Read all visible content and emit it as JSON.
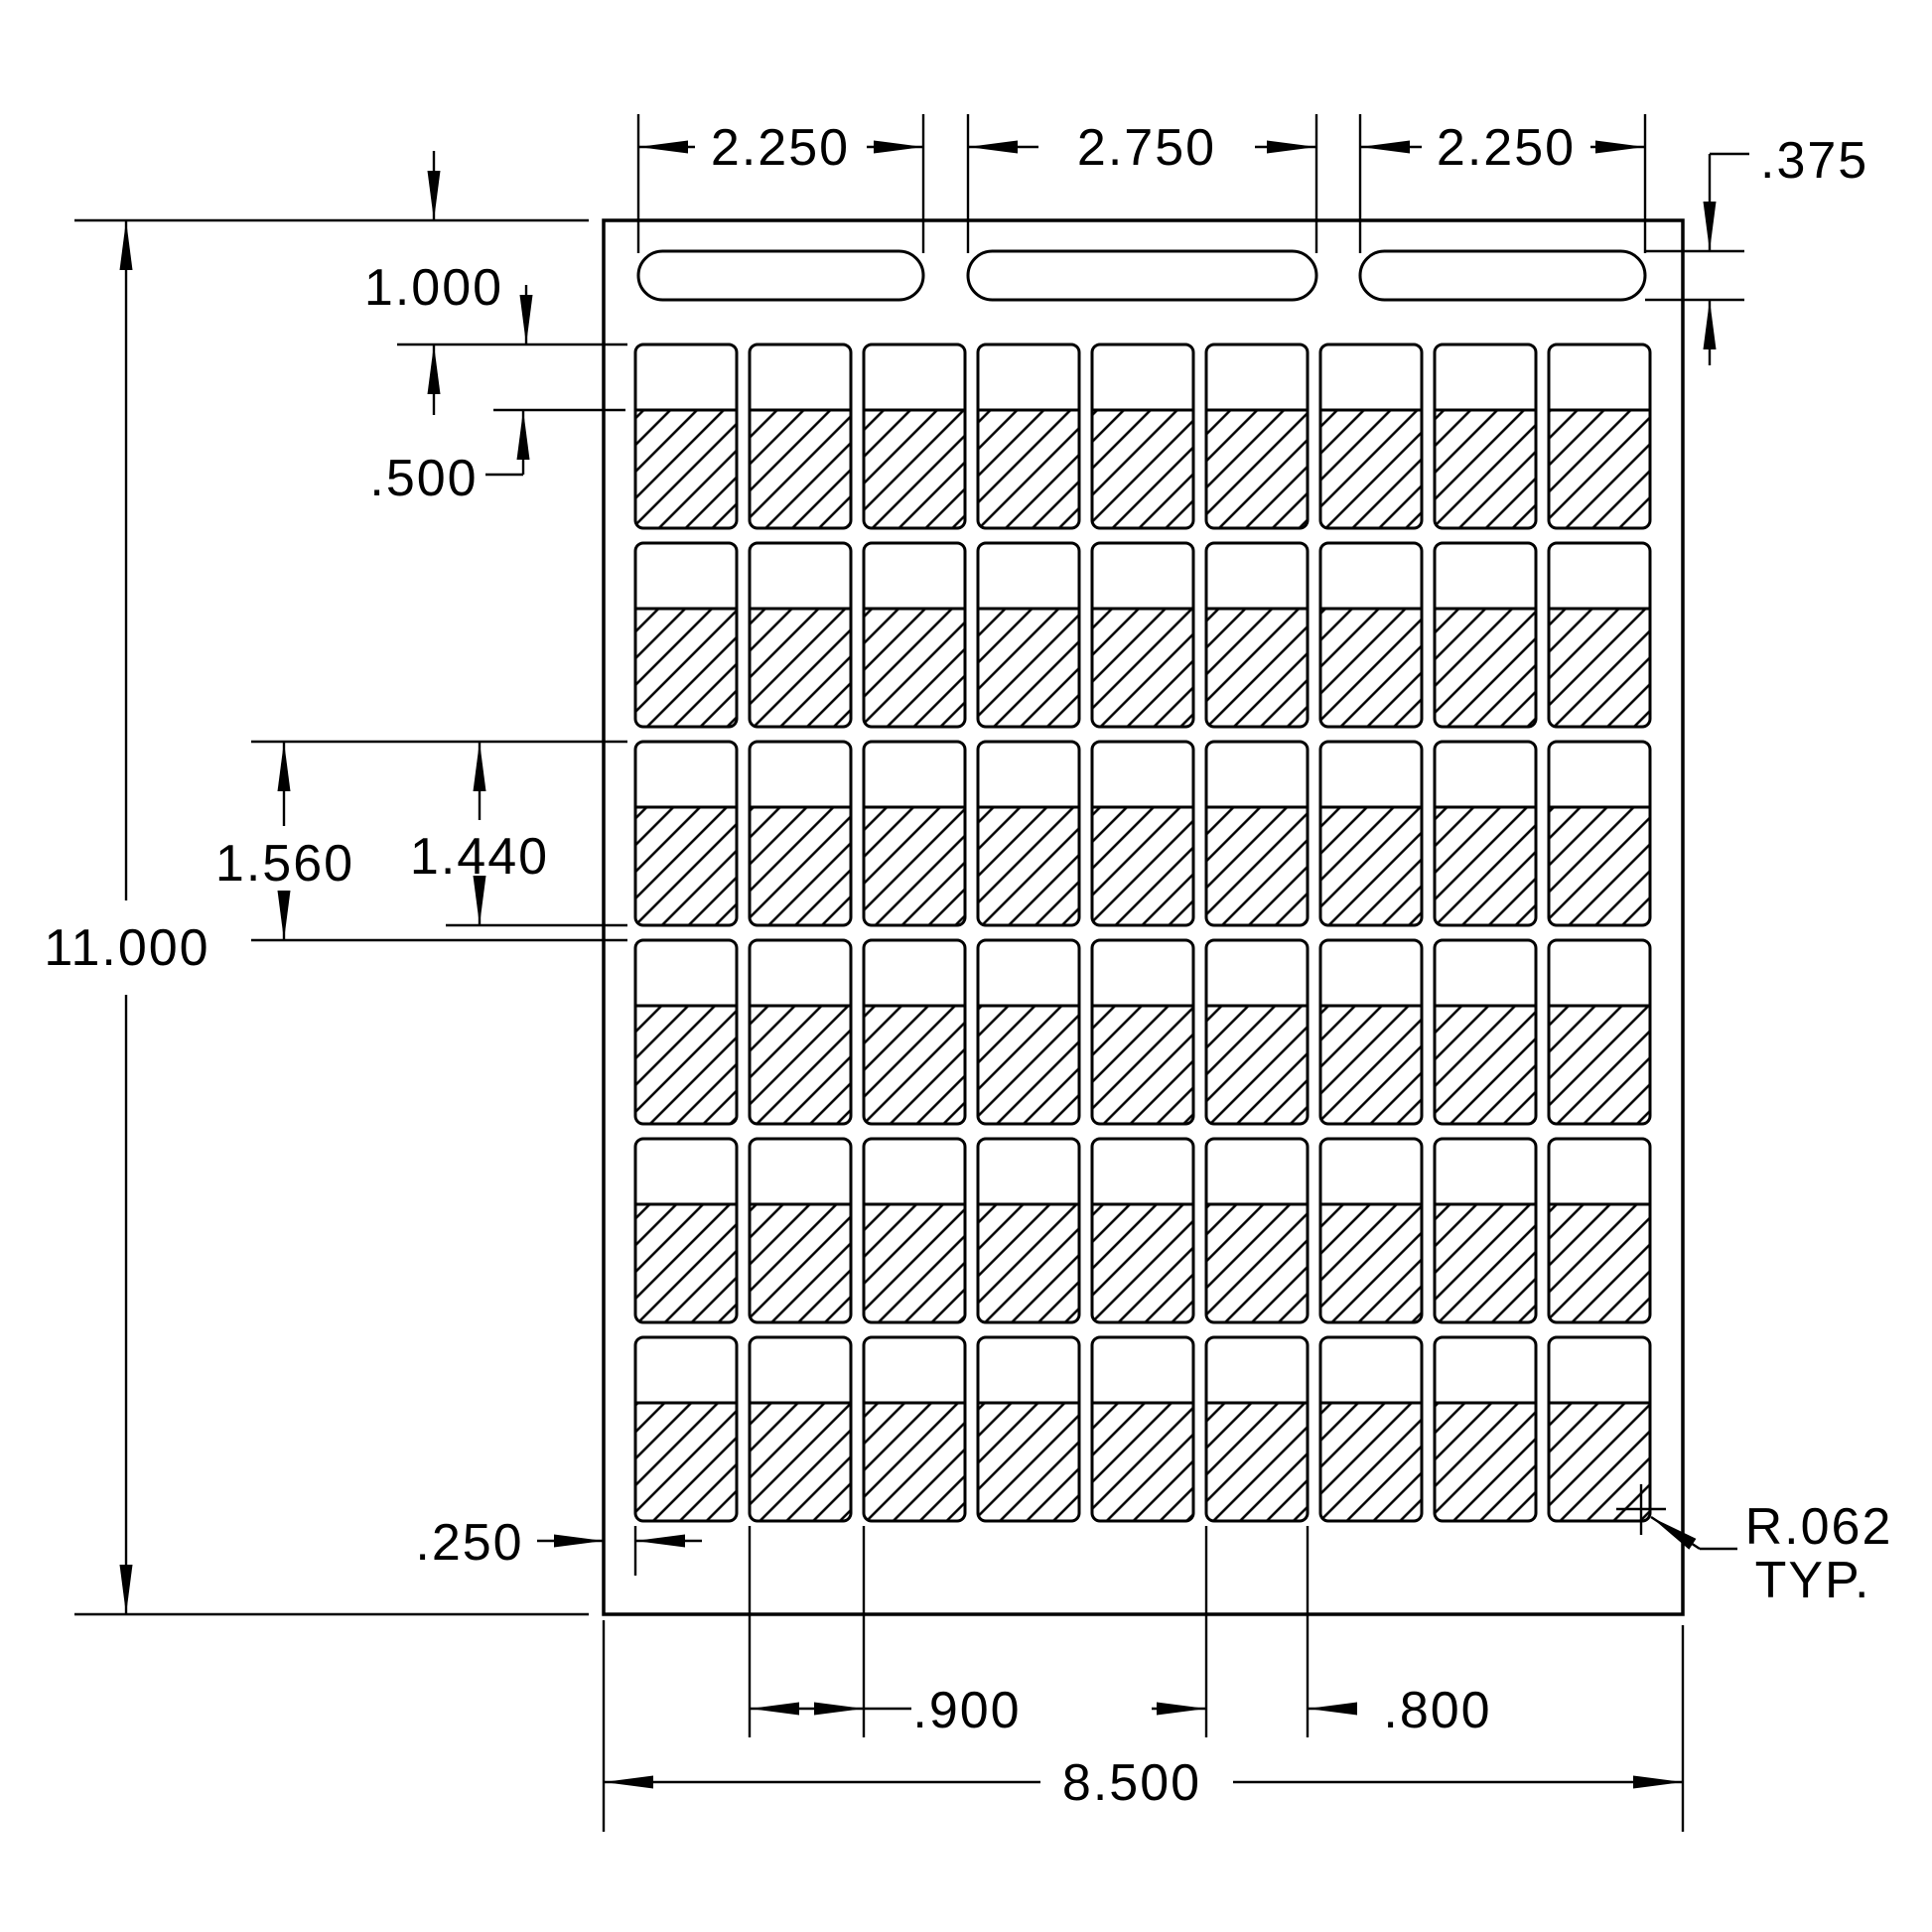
{
  "drawing": {
    "grid": {
      "label_rows": 6,
      "label_columns": 9,
      "slot_count": 3
    },
    "dimensions": {
      "slot_width_left": "2.250",
      "slot_width_center": "2.750",
      "slot_width_right": "2.250",
      "slot_height": ".375",
      "top_margin": "1.000",
      "hatch_inset": ".500",
      "row_pitch": "1.560",
      "label_height": "1.440",
      "sheet_height": "11.000",
      "left_margin": ".250",
      "column_pitch": ".900",
      "label_width": ".800",
      "sheet_width": "8.500"
    },
    "notes": {
      "corner_radius_value": "R.062",
      "corner_radius_qualifier": "TYP."
    },
    "colors": {
      "line": "#000000",
      "background": "#ffffff"
    }
  }
}
